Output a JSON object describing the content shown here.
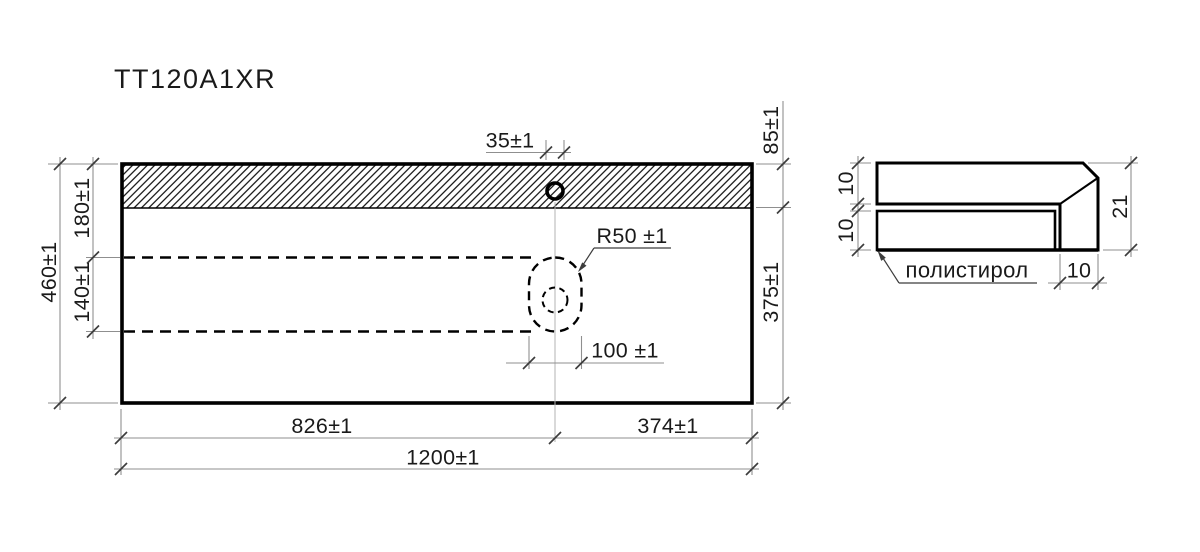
{
  "title": "TT120A1XR",
  "front_view": {
    "hole_diameter": "35±1",
    "back_zone_depth": "85±1",
    "front_zone_depth": "375±1",
    "total_depth": "460±1",
    "sink_offset_from_back": "180±1",
    "sink_cutout_length": "140±1",
    "sink_corner_radius": "R50 ±1",
    "sink_cutout_width": "100 ±1",
    "width_left_segment": "826±1",
    "width_right_segment": "374±1",
    "total_width": "1200±1"
  },
  "section_view": {
    "top_layer_thickness": "10",
    "core_layer_thickness": "10",
    "total_thickness": "21",
    "edge_strip_width": "10",
    "core_material_label": "полистирол"
  },
  "colors": {
    "background": "#ffffff",
    "outline": "#000000",
    "dimline": "#8f8f8f",
    "tick": "#3c3c3c",
    "centerline": "#b3b3b3",
    "text": "#1a1a1a"
  }
}
